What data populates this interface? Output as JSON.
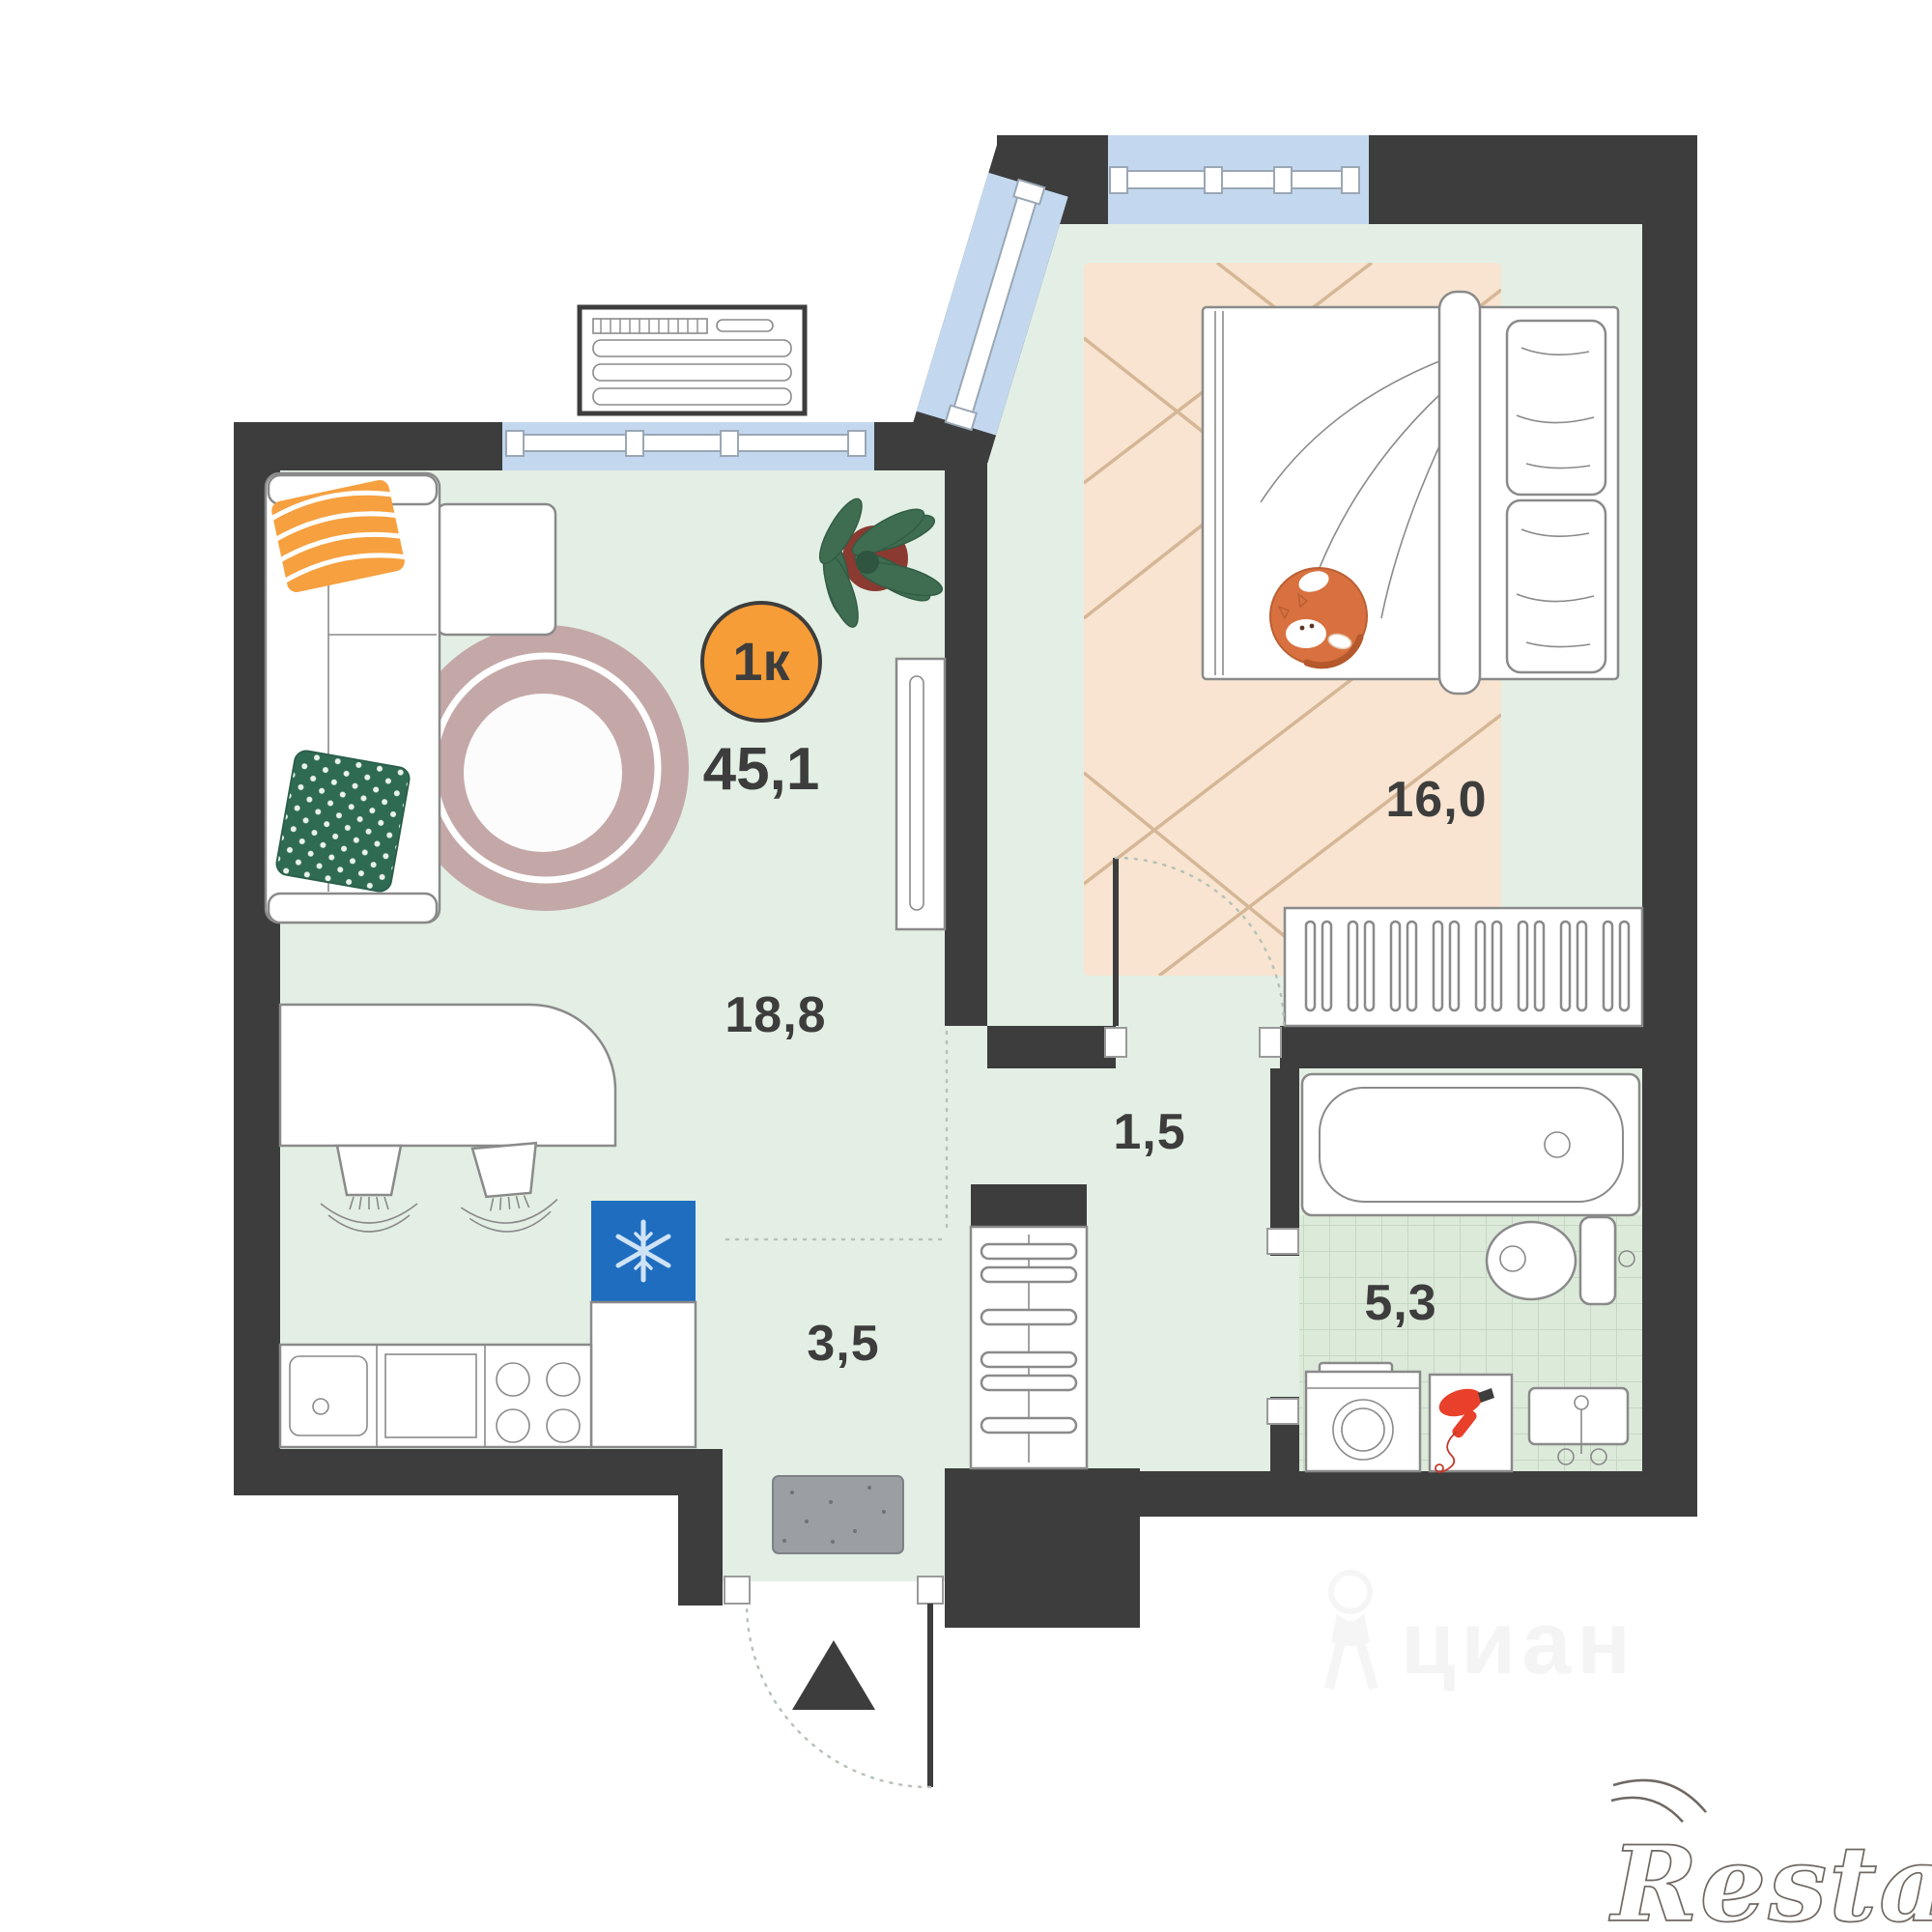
{
  "plan": {
    "type_badge": {
      "label": "1к"
    },
    "total_area": "45,1",
    "areas": {
      "living_kitchen": "18,8",
      "bedroom": "16,0",
      "hallway": "1,5",
      "entry": "3,5",
      "bathroom": "5,3"
    }
  },
  "watermarks": {
    "realtor": "Restate",
    "portal": "циан"
  },
  "colors": {
    "wall": "#3d3d3d",
    "floor": "#e3efe4",
    "window_blue": "#c3d8ef",
    "badge_orange": "#f69d38",
    "fridge_blue": "#1f6dbf",
    "round_rug_mauve": "#c4a8a8",
    "bedroom_rug_beige": "#f8e4d0",
    "pillow_orange": "#f6a040",
    "pillow_green": "#2f6b53",
    "cat_orange": "#d8713f",
    "dryer_red": "#e8402a",
    "doormat_gray": "#9b9ea3"
  }
}
